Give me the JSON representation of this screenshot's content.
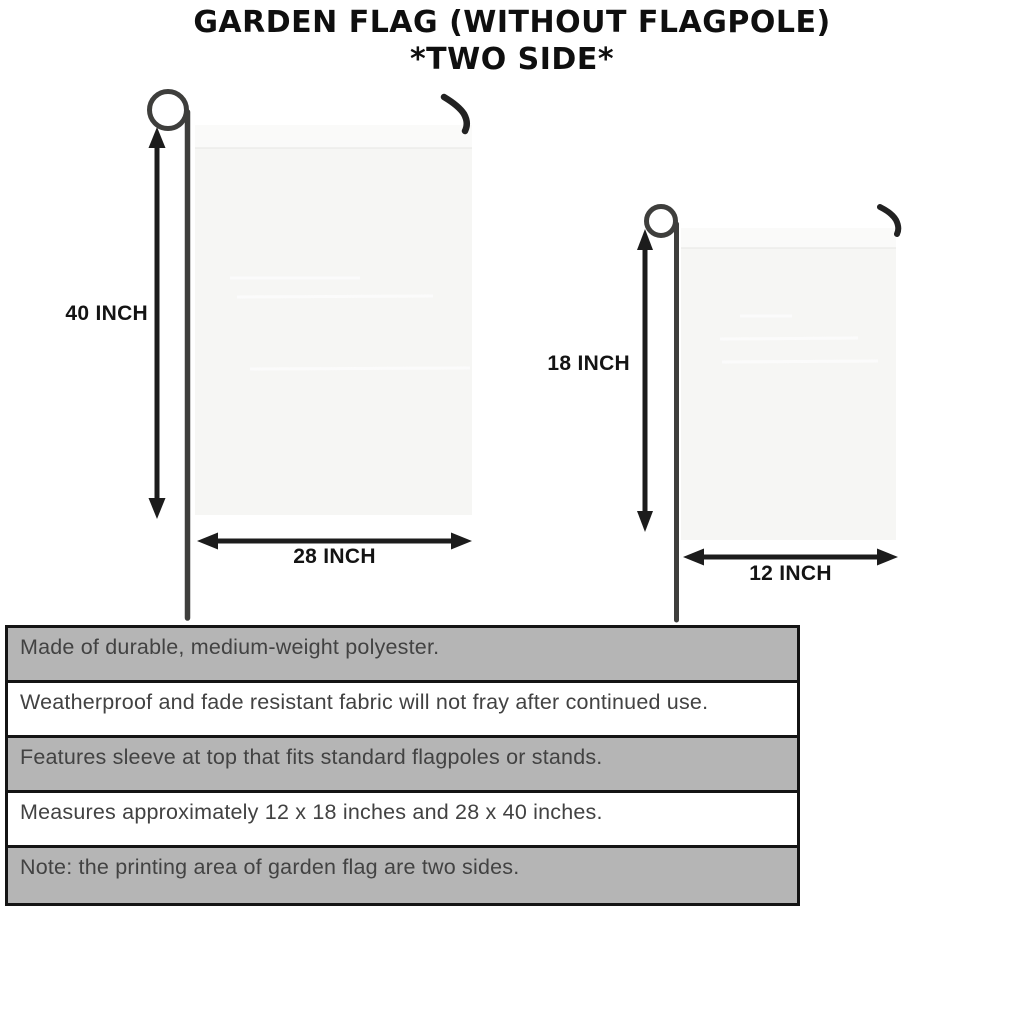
{
  "header": {
    "title": "GARDEN FLAG (WITHOUT FLAGPOLE)",
    "subtitle": "*TWO SIDE*"
  },
  "diagram": {
    "large_flag": {
      "height_label": "40 INCH",
      "width_label": "28 INCH"
    },
    "small_flag": {
      "height_label": "18 INCH",
      "width_label": "12 INCH"
    }
  },
  "features": {
    "rows": [
      "Made of durable, medium-weight polyester.",
      "Weatherproof and fade resistant fabric will not fray after continued use.",
      "Features sleeve at top that fits standard flagpoles or stands.",
      "Measures approximately 12 x 18 inches and 28 x 40 inches.",
      "Note: the printing area of garden flag are two sides."
    ]
  },
  "colors": {
    "title_text": "#0f0f0f",
    "table_row_gray": "#b5b5b5",
    "table_border": "#141414",
    "table_text": "#424242",
    "flag_fill": "#f6f6f4",
    "pole": "#3e3e3c",
    "arrow": "#1c1c1c"
  }
}
